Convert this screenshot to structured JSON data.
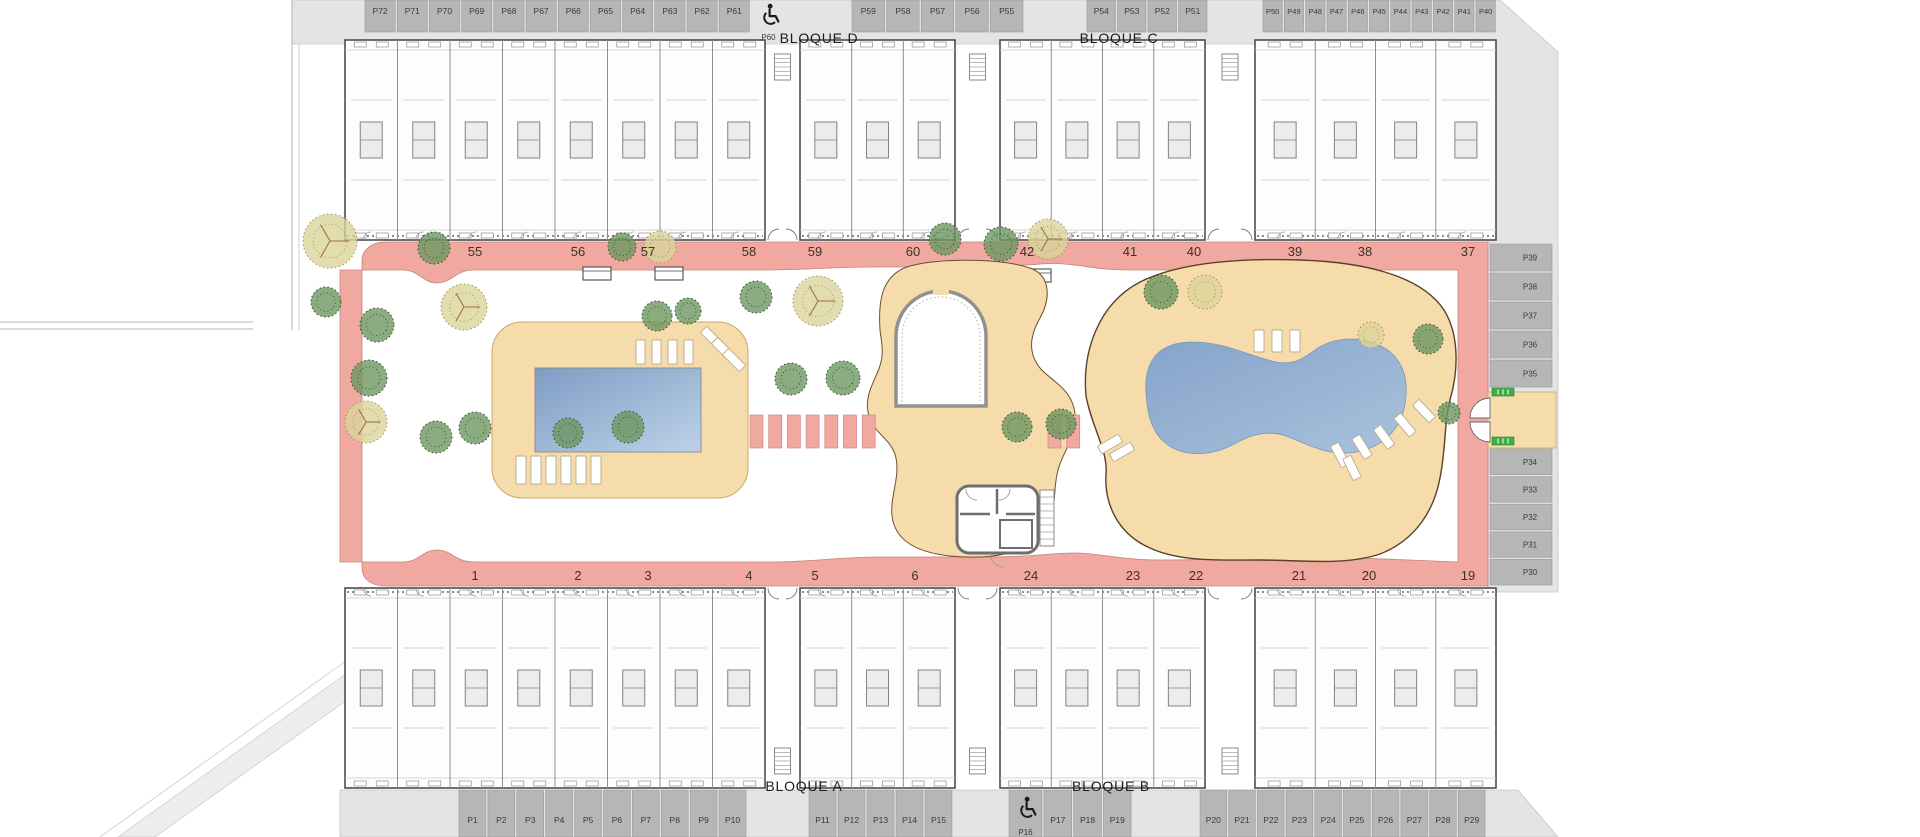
{
  "plan_title": "Residential site plan",
  "colors": {
    "pavement": "#e4e4e4",
    "pavement_edge": "#c6c6c6",
    "stall": "#b6b6b6",
    "stall_edge": "#9a9a9a",
    "stall_label": "#3a3a3a",
    "walkway": "#f0a8a1",
    "walkway_edge": "#c4857b",
    "deck": "#f6dcab",
    "deck_edge": "#c9a96e",
    "deck_edge_dark": "#5a4128",
    "pool_dark": "#7e9cc4",
    "pool_light": "#bcd2e8",
    "building_fill": "#fdfdfd",
    "building_edge": "#4d4d4d",
    "tree_dark": "#6d9760",
    "tree_dark_edge": "#31512c",
    "tree_olive": "#dbd49b",
    "tree_olive_edge": "#a5954d",
    "badge_green": "#3fae49",
    "unit_number": "#3a3330",
    "icon": "#1a1a1a"
  },
  "blocks": [
    {
      "label": "BLOQUE D"
    },
    {
      "label": "BLOQUE C"
    },
    {
      "label": "BLOQUE A"
    },
    {
      "label": "BLOQUE B"
    }
  ],
  "parking": {
    "top_row": {
      "y": 0,
      "h": 32,
      "label_y": 14,
      "groups": [
        {
          "ids": [
            "P72",
            "P71",
            "P70",
            "P69",
            "P68",
            "P67",
            "P66",
            "P65",
            "P64",
            "P63",
            "P62",
            "P61"
          ],
          "x": 364,
          "stall_w": 32.2
        },
        {
          "ids": [
            "P60"
          ],
          "x": 751,
          "stall_w": 35,
          "accessible": true,
          "open": true
        },
        {
          "ids": [
            "P59",
            "P58",
            "P57",
            "P56",
            "P55"
          ],
          "x": 851,
          "stall_w": 34.6
        },
        {
          "ids": [
            "P54",
            "P53",
            "P52",
            "P51"
          ],
          "x": 1086,
          "stall_w": 30.5
        },
        {
          "ids": [
            "P50",
            "P49",
            "P48",
            "P47",
            "P46",
            "P45",
            "P44",
            "P43",
            "P42",
            "P41",
            "P40"
          ],
          "x": 1262,
          "stall_w": 21.3,
          "font": 7.5
        }
      ]
    },
    "right_column": {
      "x": 1490,
      "w": 62,
      "label_x": 1530,
      "groups": [
        {
          "ids": [
            "P39",
            "P38",
            "P37",
            "P36",
            "P35"
          ],
          "y": 243,
          "stall_h": 29
        },
        {
          "ids": [
            "P34",
            "P33",
            "P32",
            "P31",
            "P30"
          ],
          "y": 448,
          "stall_h": 27.6
        }
      ],
      "entrance": {
        "x": 1488,
        "y": 392,
        "w": 68,
        "h": 56
      }
    },
    "bottom_row": {
      "y": 790,
      "h": 47,
      "label_y": 823,
      "groups": [
        {
          "ids": [
            "P1",
            "P2",
            "P3",
            "P4",
            "P5",
            "P6",
            "P7",
            "P8",
            "P9",
            "P10"
          ],
          "x": 458,
          "stall_w": 28.9
        },
        {
          "ids": [
            "P11",
            "P12",
            "P13",
            "P14",
            "P15"
          ],
          "x": 808,
          "stall_w": 29
        },
        {
          "ids": [
            "P16"
          ],
          "x": 1008,
          "stall_w": 35,
          "accessible": true,
          "label_y": 835
        },
        {
          "ids": [
            "P17",
            "P18",
            "P19"
          ],
          "x": 1043,
          "stall_w": 29.7
        },
        {
          "ids": [
            "P20",
            "P21",
            "P22",
            "P23",
            "P24",
            "P25",
            "P26",
            "P27",
            "P28",
            "P29"
          ],
          "x": 1199,
          "stall_w": 28.7
        }
      ]
    }
  },
  "unit_numbers": [
    {
      "label": "55",
      "x": 475,
      "y": 252
    },
    {
      "label": "56",
      "x": 578,
      "y": 252
    },
    {
      "label": "57",
      "x": 648,
      "y": 252
    },
    {
      "label": "58",
      "x": 749,
      "y": 252
    },
    {
      "label": "59",
      "x": 815,
      "y": 252
    },
    {
      "label": "60",
      "x": 913,
      "y": 252
    },
    {
      "label": "42",
      "x": 1027,
      "y": 252
    },
    {
      "label": "41",
      "x": 1130,
      "y": 252
    },
    {
      "label": "40",
      "x": 1194,
      "y": 252
    },
    {
      "label": "39",
      "x": 1295,
      "y": 252
    },
    {
      "label": "38",
      "x": 1365,
      "y": 252
    },
    {
      "label": "37",
      "x": 1468,
      "y": 252
    },
    {
      "label": "1",
      "x": 475,
      "y": 576
    },
    {
      "label": "2",
      "x": 578,
      "y": 576
    },
    {
      "label": "3",
      "x": 648,
      "y": 576
    },
    {
      "label": "4",
      "x": 749,
      "y": 576
    },
    {
      "label": "5",
      "x": 815,
      "y": 576
    },
    {
      "label": "6",
      "x": 915,
      "y": 576
    },
    {
      "label": "24",
      "x": 1031,
      "y": 576
    },
    {
      "label": "23",
      "x": 1133,
      "y": 576
    },
    {
      "label": "22",
      "x": 1196,
      "y": 576
    },
    {
      "label": "21",
      "x": 1299,
      "y": 576
    },
    {
      "label": "20",
      "x": 1369,
      "y": 576
    },
    {
      "label": "19",
      "x": 1468,
      "y": 576
    }
  ],
  "buildings": {
    "rows": [
      {
        "y": 40,
        "h": 200,
        "court": "bottom"
      },
      {
        "y": 588,
        "h": 200,
        "court": "top"
      }
    ],
    "segments": [
      {
        "x": 345,
        "w": 420
      },
      {
        "x": 800,
        "w": 155
      },
      {
        "x": 1000,
        "w": 205
      },
      {
        "x": 1255,
        "w": 241
      }
    ],
    "corridors": [
      {
        "x": 765,
        "w": 35
      },
      {
        "x": 955,
        "w": 45
      },
      {
        "x": 1205,
        "w": 50
      }
    ]
  },
  "amenities": {
    "pool_left": {
      "x": 535,
      "y": 368,
      "w": 166,
      "h": 84
    },
    "deck_left": {
      "x": 492,
      "y": 322,
      "w": 256,
      "h": 176
    },
    "arch_enclosure": {
      "x": 896,
      "y": 336,
      "w": 90,
      "bottom": 406
    },
    "services_building": {
      "x": 957,
      "y": 486,
      "w": 81,
      "h": 67
    }
  },
  "trees": [
    [
      330,
      241,
      27,
      "o"
    ],
    [
      326,
      302,
      15,
      "d"
    ],
    [
      377,
      325,
      17,
      "d"
    ],
    [
      369,
      378,
      18,
      "d"
    ],
    [
      366,
      422,
      21,
      "o"
    ],
    [
      434,
      248,
      16,
      "d"
    ],
    [
      464,
      307,
      23,
      "o"
    ],
    [
      436,
      437,
      16,
      "d"
    ],
    [
      475,
      428,
      16,
      "d"
    ],
    [
      568,
      433,
      15,
      "d"
    ],
    [
      628,
      427,
      16,
      "d"
    ],
    [
      622,
      247,
      14,
      "d"
    ],
    [
      660,
      247,
      16,
      "o"
    ],
    [
      657,
      316,
      15,
      "d"
    ],
    [
      688,
      311,
      13,
      "d"
    ],
    [
      756,
      297,
      16,
      "d"
    ],
    [
      818,
      301,
      25,
      "o"
    ],
    [
      791,
      379,
      16,
      "d"
    ],
    [
      843,
      378,
      17,
      "d"
    ],
    [
      945,
      239,
      16,
      "d"
    ],
    [
      1001,
      244,
      17,
      "d"
    ],
    [
      1048,
      239,
      20,
      "o"
    ],
    [
      1017,
      427,
      15,
      "d"
    ],
    [
      1061,
      424,
      15,
      "d"
    ],
    [
      1161,
      292,
      17,
      "d"
    ],
    [
      1205,
      292,
      17,
      "o"
    ],
    [
      1371,
      335,
      13,
      "o"
    ],
    [
      1428,
      339,
      15,
      "d"
    ],
    [
      1449,
      413,
      11,
      "d"
    ]
  ],
  "benches": [
    [
      583,
      267
    ],
    [
      655,
      267
    ],
    [
      1023,
      269
    ]
  ],
  "stepping_stones": {
    "y": 415,
    "h": 33,
    "w": 13,
    "left": {
      "x0": 750,
      "n": 7,
      "step": 18.7
    },
    "right": {
      "x0": 1048,
      "n": 2,
      "step": 18.7
    }
  },
  "lounger_groups": [
    {
      "x": 636,
      "y": 340,
      "n": 4,
      "w": 9,
      "h": 24,
      "gap": 7
    },
    {
      "x": 516,
      "y": 456,
      "n": 6,
      "w": 10,
      "h": 28,
      "gap": 5
    },
    {
      "x": 1254,
      "y": 330,
      "n": 3,
      "w": 10,
      "h": 22,
      "gap": 8
    }
  ],
  "lounger_singles": [
    [
      712,
      338,
      -45
    ],
    [
      723,
      349,
      -45
    ],
    [
      734,
      360,
      -45
    ],
    [
      1110,
      444,
      60
    ],
    [
      1122,
      452,
      60
    ],
    [
      1340,
      455,
      -28
    ],
    [
      1362,
      447,
      -32
    ],
    [
      1384,
      437,
      -36
    ],
    [
      1405,
      425,
      -40
    ],
    [
      1424,
      411,
      -44
    ],
    [
      1352,
      468,
      -26
    ]
  ],
  "green_badges": [
    [
      1492,
      388
    ],
    [
      1492,
      437
    ]
  ]
}
